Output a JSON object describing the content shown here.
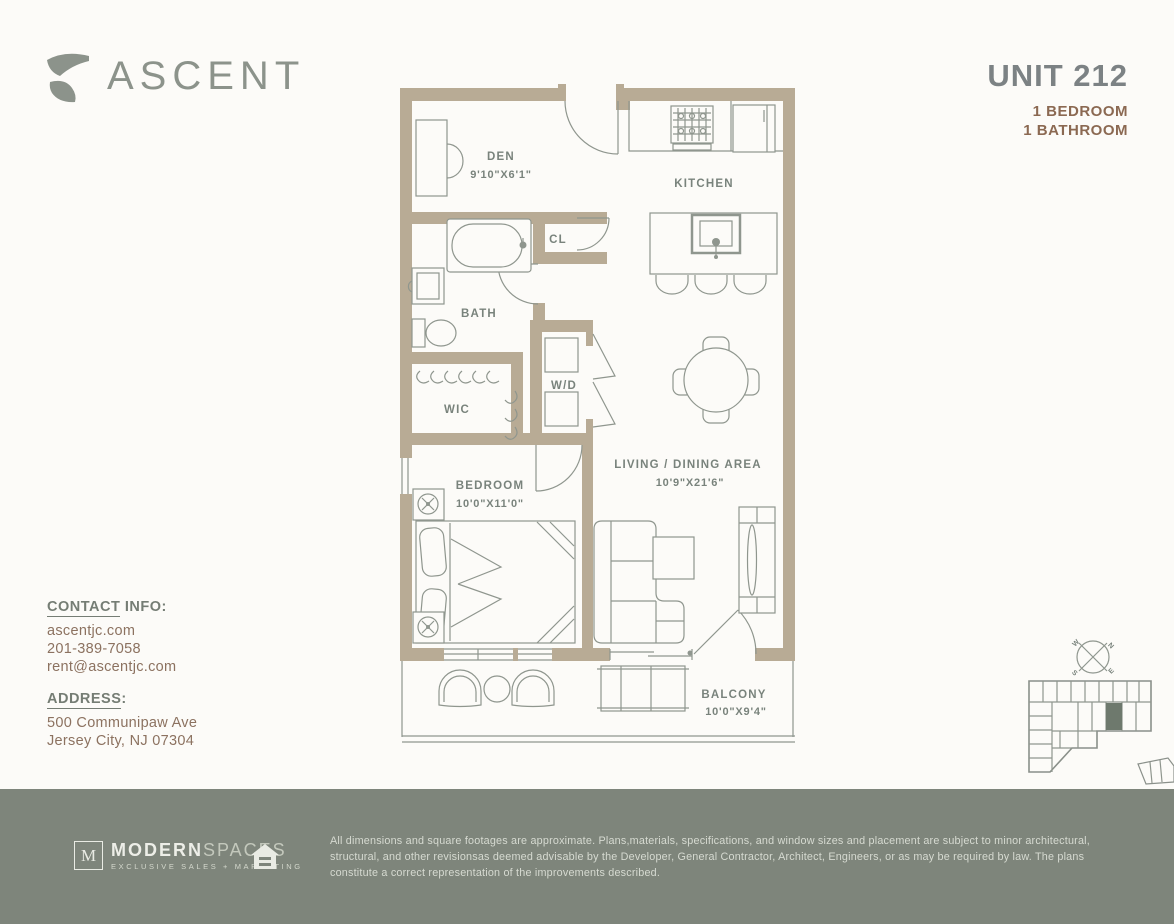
{
  "header": {
    "logo_text": "ASCENT",
    "unit_title": "UNIT 212",
    "spec_bedroom": "1 BEDROOM",
    "spec_bathroom": "1 BATHROOM"
  },
  "plan": {
    "rooms": {
      "den": {
        "name": "DEN",
        "dims": "9'10\"X6'1\""
      },
      "kitchen": {
        "name": "KITCHEN"
      },
      "cl": {
        "name": "CL"
      },
      "bath": {
        "name": "BATH"
      },
      "wd": {
        "name": "W/D"
      },
      "wic": {
        "name": "WIC"
      },
      "bedroom": {
        "name": "BEDROOM",
        "dims": "10'0\"X11'0\""
      },
      "living": {
        "name": "LIVING / DINING AREA",
        "dims": "10'9\"X21'6\""
      },
      "balcony": {
        "name": "BALCONY",
        "dims": "10'0\"X9'4\""
      }
    }
  },
  "contact": {
    "heading_underlined": "CONTACT",
    "heading_rest": " INFO:",
    "website": "ascentjc.com",
    "phone": "201-389-7058",
    "email": "rent@ascentjc.com"
  },
  "address": {
    "heading_underlined": "ADDRESS",
    "heading_rest": ":",
    "line1": "500 Communipaw Ave",
    "line2": "Jersey City, NJ 07304"
  },
  "compass": {
    "n": "N",
    "e": "E",
    "s": "S",
    "w": "W"
  },
  "footer": {
    "brand_initial": "M",
    "brand_primary": "MODERN",
    "brand_secondary": "SPACES",
    "brand_tagline": "EXCLUSIVE SALES + MARKETING",
    "disclaimer": "All dimensions and square footages are approximate. Plans,materials, specifications, and window sizes and placement are subject to minor architectural, structural, and other revisionsas deemed advisable by the Developer, General Contractor, Architect, Engineers, or as may be required by law. The plans constitute a correct representation of the improvements described."
  },
  "colors": {
    "wall": "#b8ab95",
    "line": "#8f968e",
    "accent_brown": "#8b6952",
    "gray_green": "#8c938b",
    "footer_bg": "#7e857b",
    "keyplan_highlight": "#6e796d"
  }
}
